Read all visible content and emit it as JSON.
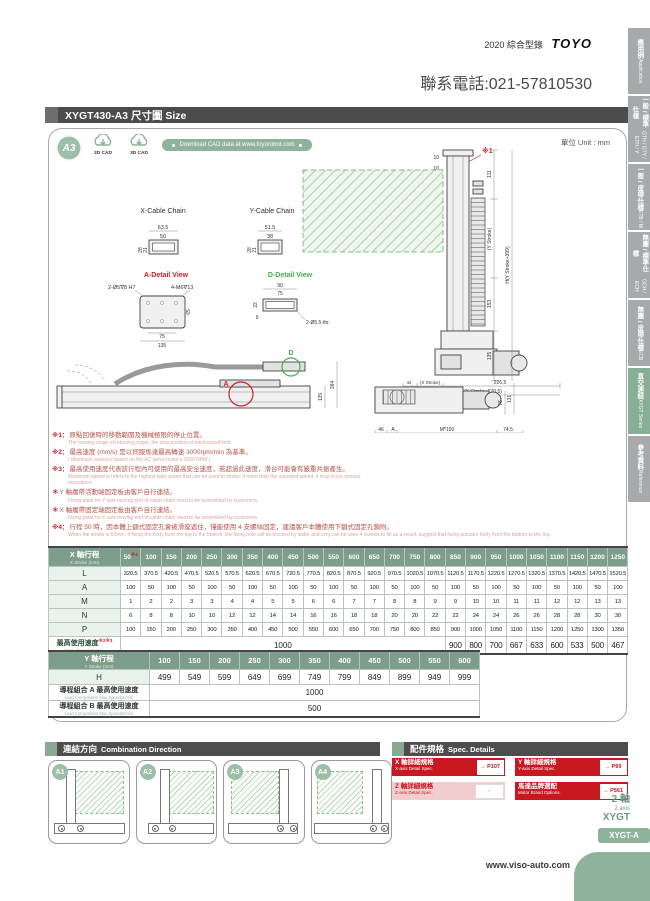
{
  "page": {
    "catalog": "2020 綜合型錄",
    "brand": "TOYO",
    "phone": "聯系電話:021-57810530",
    "title": "XYGT430-A3 尺寸圖 Size",
    "unit": "單位 Unit : mm",
    "site": "www.viso-auto.com"
  },
  "sidebar": {
    "tabs": [
      {
        "label": "應用例",
        "sub": "Application",
        "active": false
      },
      {
        "label": "一般 / 標準仕樣",
        "sub": "GTH / GTY / ETH / Y",
        "active": false
      },
      {
        "label": "一般 / 皮帶仕樣",
        "sub": "ETB / M",
        "active": false
      },
      {
        "label": "無塵 / 標準仕樣",
        "sub": "GCH / ECH",
        "active": false
      },
      {
        "label": "無塵 / 皮帶仕樣",
        "sub": "ECB",
        "active": false
      },
      {
        "label": "直交連結",
        "sub": "XYGT Series",
        "active": true
      },
      {
        "label": "參考資料",
        "sub": "Reference",
        "active": false
      }
    ]
  },
  "cad": {
    "badge": "A3",
    "cad2d": "2D CAD",
    "cad3d": "3D CAD",
    "download": "Download CAD data at www.toyorobot.com"
  },
  "dims": {
    "x_cable": {
      "title": "X-Cable Chain",
      "w_out": "63.5",
      "w_in": "50",
      "h_out": "28",
      "h_in": "21"
    },
    "y_cable": {
      "title": "Y-Cable Chain",
      "w_out": "51.5",
      "w_in": "38",
      "h_out": "28",
      "h_in": "21"
    },
    "a_detail": {
      "title": "A-Detail View",
      "hole1": "2-Ø5∇8 H7",
      "hole2": "4-M6∇13",
      "h": "65",
      "w_in": "75",
      "w_out": "135"
    },
    "d_detail": {
      "title": "D-Detail View",
      "w_out": "90",
      "w_in": "75",
      "h": "22",
      "off": "9",
      "hole": "2-Ø5.5-thr."
    },
    "b_detail": {
      "title": "B-Detail View",
      "hole": "2-∨Ø10.4+Ø5.5-thr.",
      "h": "37",
      "w": "8",
      "tol": "6 +0.012/0"
    },
    "c_view": {
      "title": "C View"
    },
    "elev": {
      "ref": "※1",
      "t1": "10",
      "t2": "10",
      "d111": "111",
      "ys": "(Y Stroke)",
      "h": "H(Y Stroke+399)",
      "d153": "153",
      "d135": "135",
      "d44": "44",
      "xs": "(X Stroke)",
      "d2265": "226.5",
      "l": "L (X Stroke+270.5)"
    },
    "side": {
      "d284": "284",
      "d135": "135",
      "a": "A",
      "d": "D",
      "d131": "131",
      "d76": "76"
    },
    "top": {
      "d46": "46",
      "a": "A",
      "m100": "M*100",
      "d745": "74.5",
      "holes": "N-M8∇16+Ø6.8-thr.",
      "b": "B",
      "c": "C",
      "hole2": "2-Ø6∇7 H7",
      "p": "P",
      "d745b": "74.5",
      "d100": "100±0.02",
      "d120": "120",
      "d108": "108"
    }
  },
  "notes": [
    {
      "no": "※1：",
      "zh": "原點回復時的移動範圍及機械極限的停止位置。",
      "en": "The moving range of returning origin, the stop position of mechanical limit.",
      "wide": false
    },
    {
      "no": "※2：",
      "zh": "最高速度 (mm/s) 是以伺服馬達最高轉速 3000rpm/min 為基準。",
      "en": "( Maximum speed is based on the AC servo motor's 3000 RPM )",
      "wide": false
    },
    {
      "no": "※3：",
      "zh": "最高使用速度代表該行程內可使用的最高安全速度，若超過此速度，滑台可能會有嚴重共振產生。",
      "en": "Maximum speed is refers to the highest safe speed that can be used in stroke, if more than the standard speed, it may occur serious resonance.",
      "wide": false
    },
    {
      "no": "＊",
      "zh": "Y 軸履帶活動端固定板由客戶自行連結。",
      "en": "Fixing plate for Y axis moving end of cable chain need to be assembled by customers.",
      "wide": false
    },
    {
      "no": "＊",
      "zh": "X 軸履帶固定端固定板由客戶自行連結。",
      "en": "Fixing plate for X axis moving end of cable chain need to be assembled by customers.",
      "wide": false
    },
    {
      "no": "※4：",
      "zh": "行程 50 時，因本體上額式固定孔會被滑座遮住，僅能使用 4 支螺絲固定，建議客戶本體使用下額式固定孔鎖附。",
      "en": "When the stroke is 50mm, if fixing the body from the top to the bottom, the fixing hole will be blocked by slider and only can be uses 4 screws to fix as a result, suggest that fixing actuator body from the bottom to the top.",
      "wide": true
    }
  ],
  "x_table": {
    "title_zh": "X 軸行程",
    "title_en": "X Stroke (mm)",
    "col0_sup": "※4",
    "cols": [
      "50",
      "100",
      "150",
      "200",
      "250",
      "300",
      "350",
      "400",
      "450",
      "500",
      "550",
      "600",
      "650",
      "700",
      "750",
      "800",
      "850",
      "900",
      "950",
      "1000",
      "1050",
      "1100",
      "1150",
      "1200",
      "1250"
    ],
    "rows": [
      {
        "label": "L",
        "cells": [
          "320.5",
          "370.5",
          "420.5",
          "470.5",
          "520.5",
          "570.5",
          "620.5",
          "670.5",
          "720.5",
          "770.5",
          "820.5",
          "870.5",
          "920.5",
          "970.5",
          "1020.5",
          "1070.5",
          "1120.5",
          "1170.5",
          "1220.5",
          "1270.5",
          "1320.5",
          "1370.5",
          "1420.5",
          "1470.5",
          "1520.5"
        ]
      },
      {
        "label": "A",
        "cells": [
          "100",
          "50",
          "100",
          "50",
          "100",
          "50",
          "100",
          "50",
          "100",
          "50",
          "100",
          "50",
          "100",
          "50",
          "100",
          "50",
          "100",
          "50",
          "100",
          "50",
          "100",
          "50",
          "100",
          "50",
          "100"
        ]
      },
      {
        "label": "M",
        "cells": [
          "1",
          "2",
          "2",
          "3",
          "3",
          "4",
          "4",
          "5",
          "5",
          "6",
          "6",
          "7",
          "7",
          "8",
          "8",
          "9",
          "9",
          "10",
          "10",
          "11",
          "11",
          "12",
          "12",
          "13",
          "13"
        ]
      },
      {
        "label": "N",
        "cells": [
          "6",
          "8",
          "8",
          "10",
          "10",
          "12",
          "12",
          "14",
          "14",
          "16",
          "16",
          "18",
          "18",
          "20",
          "20",
          "22",
          "22",
          "24",
          "24",
          "26",
          "26",
          "28",
          "28",
          "30",
          "30"
        ]
      },
      {
        "label": "P",
        "cells": [
          "100",
          "150",
          "200",
          "250",
          "300",
          "350",
          "400",
          "450",
          "500",
          "550",
          "600",
          "650",
          "700",
          "750",
          "800",
          "850",
          "900",
          "1000",
          "1050",
          "1100",
          "1150",
          "1200",
          "1250",
          "1300",
          "1350"
        ]
      },
      {
        "label_zh": "最高使用速度",
        "sup": "※2※3",
        "label_en": "Max. Speed (mm/s)",
        "speed": true,
        "cells": [
          {
            "text": "1000",
            "span": 16
          },
          "900",
          "800",
          "700",
          "667",
          "633",
          "600",
          "533",
          "500",
          "467"
        ]
      }
    ]
  },
  "y_table": {
    "title_zh": "Y 軸行程",
    "title_en": "Y Stroke (mm)",
    "cols": [
      "100",
      "150",
      "200",
      "250",
      "300",
      "350",
      "400",
      "450",
      "500",
      "550",
      "600"
    ],
    "rows": [
      {
        "label": "H",
        "cells": [
          "499",
          "549",
          "599",
          "649",
          "699",
          "749",
          "799",
          "849",
          "899",
          "949",
          "999"
        ]
      },
      {
        "label_zh": "導程組合 A 最高使用速度",
        "label_en": "Lead Composition Max.Speed(mm/s)",
        "cells": [
          {
            "text": "1000",
            "span": 11
          }
        ]
      },
      {
        "label_zh": "導程組合 B 最高使用速度",
        "label_en": "Lead Composition Max.Speed(mm/s)",
        "cells": [
          {
            "text": "500",
            "span": 11
          }
        ]
      }
    ]
  },
  "combination": {
    "title_zh": "連結方向",
    "title_en": "Combination Direction",
    "cards": [
      {
        "id": "A1",
        "variant": "v1"
      },
      {
        "id": "A2",
        "variant": "v2"
      },
      {
        "id": "A3",
        "variant": "v3"
      },
      {
        "id": "A4",
        "variant": "v4"
      }
    ]
  },
  "specs": {
    "title_zh": "配件規格",
    "title_en": "Spec. Details",
    "items": [
      {
        "zh": "X 軸詳細規格",
        "en": "X-axis Detail Spec.",
        "page": "→ P107",
        "muted": false
      },
      {
        "zh": "Y 軸詳細規格",
        "en": "Y-axis Detail Spec.",
        "page": "→ P99",
        "muted": false
      },
      {
        "zh": "Z 軸詳細規格",
        "en": "Z-axis Detail Spec.",
        "page": "-",
        "muted": true
      },
      {
        "zh": "馬達品牌選配",
        "en": "Motor Brand Options.",
        "page": "→ P561",
        "muted": false
      }
    ]
  },
  "series_tag": {
    "axis_zh": "2 軸",
    "axis_en": "2 axis",
    "series": "XYGT",
    "model": "XYGT-A"
  }
}
